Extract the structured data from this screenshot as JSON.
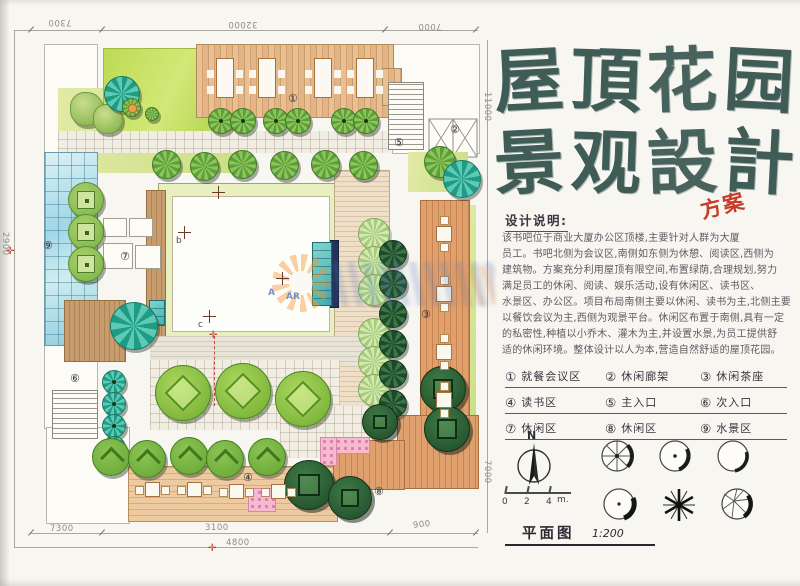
{
  "title": {
    "chars": [
      "屋",
      "頂",
      "花",
      "园",
      "景",
      "观",
      "設",
      "計"
    ],
    "stamp": "方案"
  },
  "notes": {
    "heading": "设计说明:",
    "lines": [
      "该书吧位于商业大厦办公区顶楼,主要针对人群为大厦",
      "员工。书吧北侧为会议区,南侧如东侧为休憩、阅读区,西侧为",
      "建筑物。方案充分利用屋顶有限空间,布置绿荫,合理规划,努力",
      "满足员工的休闲、阅读、娱乐活动,设有休闲区、读书区、",
      "水景区、办公区。项目布局南侧主要以休闲、读书为主,北侧主要",
      "以餐饮会议为主,西侧为观景平台。休闲区布置于南侧,具有一定",
      "的私密性,种植以小乔木、灌木为主,并设置水景,为员工提供舒",
      "适的休闲环境。整体设计以人为本,营造自然舒适的屋顶花园。"
    ]
  },
  "legend": {
    "items": [
      {
        "num": "①",
        "label": "就餐会议区"
      },
      {
        "num": "②",
        "label": "休闲廊架"
      },
      {
        "num": "③",
        "label": "休闲茶座"
      },
      {
        "num": "④",
        "label": "读书区"
      },
      {
        "num": "⑤",
        "label": "主入口"
      },
      {
        "num": "⑥",
        "label": "次入口"
      },
      {
        "num": "⑦",
        "label": "休闲区"
      },
      {
        "num": "⑧",
        "label": "休闲区"
      },
      {
        "num": "⑨",
        "label": "水景区"
      }
    ]
  },
  "compass": {
    "label": "N"
  },
  "scalebar": {
    "t0": "0",
    "t1": "2",
    "t2": "4",
    "unit": "m."
  },
  "plan_title": {
    "text": "平面图",
    "scale": "1:200"
  },
  "dimensions": {
    "top": [
      "7300",
      "32000",
      "7000"
    ],
    "left": "2900",
    "right_top": "11000",
    "right_bottom": "7000",
    "bottom": [
      "7300",
      "3100",
      "900"
    ],
    "total": "4800"
  },
  "plan": {
    "markers": [
      {
        "num": "①"
      },
      {
        "num": "②"
      },
      {
        "num": "③"
      },
      {
        "num": "④"
      },
      {
        "num": "⑤"
      },
      {
        "num": "⑥"
      },
      {
        "num": "⑦"
      },
      {
        "num": "⑧"
      },
      {
        "num": "⑨"
      }
    ],
    "section_marks": [
      "b",
      "c"
    ],
    "watermark_letters": [
      "A",
      "AR"
    ]
  },
  "colors": {
    "title_ink": "#3f5c56",
    "stamp_red": "#c63a27",
    "lawn": "#bcdb52",
    "deck": "#e0b184",
    "glass": "#9fd6e6"
  }
}
